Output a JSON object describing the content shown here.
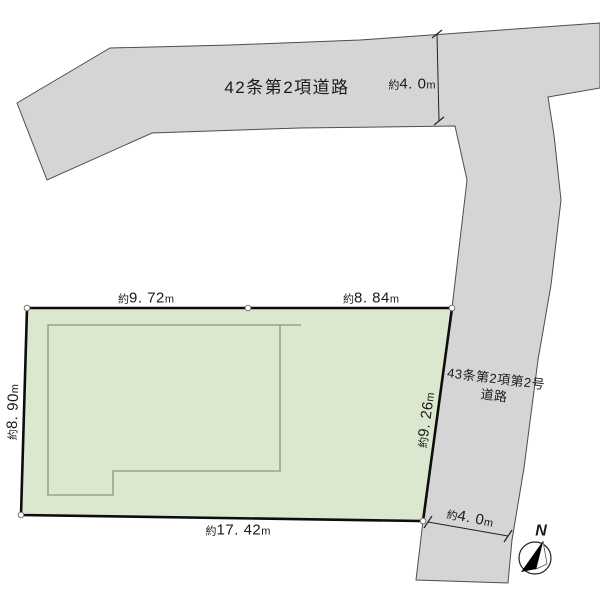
{
  "colors": {
    "background": "#ffffff",
    "road_fill": "#d5d5d5",
    "road_stroke": "#4d4d4d",
    "plot_fill": "#dbe7ce",
    "plot_stroke": "#0d0d0d",
    "building_stroke": "#97a687",
    "text": "#1a1a1a"
  },
  "roads": {
    "top": {
      "name": "42条第2項道路",
      "width": {
        "prefix": "約",
        "value": "4. 0",
        "unit": "m"
      }
    },
    "side": {
      "name_line1": "43条第2項第2号",
      "name_line2": "道路",
      "width": {
        "prefix": "約",
        "value": "4. 0",
        "unit": "m"
      }
    }
  },
  "plot": {
    "edges": {
      "top_left": {
        "prefix": "約",
        "value": "9. 72",
        "unit": "m"
      },
      "top_right": {
        "prefix": "約",
        "value": "8. 84",
        "unit": "m"
      },
      "left": {
        "prefix": "約",
        "value": "8. 90",
        "unit": "m"
      },
      "right": {
        "prefix": "約",
        "value": "9. 26",
        "unit": "m"
      },
      "bottom": {
        "prefix": "約",
        "value": "17. 42",
        "unit": "m"
      }
    }
  },
  "compass": {
    "north_label": "N"
  }
}
